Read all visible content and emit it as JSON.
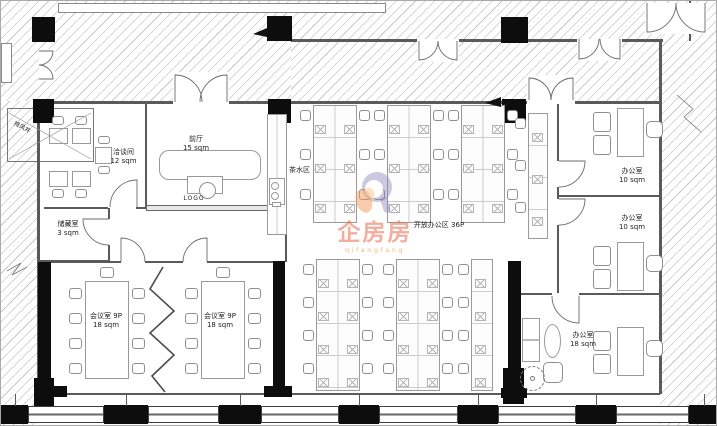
{
  "watermark": {
    "brand": "企房房",
    "pinyin": "qifangfang",
    "accent_orange": "#e96a4c",
    "accent_purple": "#9b96c4"
  },
  "rooms": {
    "exhaust_shaft": {
      "name": "排风井"
    },
    "lobby": {
      "name": "前厅",
      "area": "15 sqm"
    },
    "negotiation": {
      "name": "洽谈间",
      "area": "12 sqm"
    },
    "storage": {
      "name": "储藏室",
      "area": "3 sqm"
    },
    "tea": {
      "name": "茶水区"
    },
    "logo_wall": {
      "label": "LOGO"
    },
    "open_office": {
      "label": "开放办公区  36P"
    },
    "office_1": {
      "name": "办公室",
      "area": "10 sqm"
    },
    "office_2": {
      "name": "办公室",
      "area": "10 sqm"
    },
    "office_3": {
      "name": "办公室",
      "area": "18 sqm"
    },
    "meeting_left": {
      "name": "会议室  9P",
      "area": "18 sqm"
    },
    "meeting_right": {
      "name": "会议室  9P",
      "area": "18 sqm"
    }
  },
  "plan_colors": {
    "wall": "#5a5a5a",
    "column": "#0d0d0d",
    "hatch": "#c9c9c9"
  }
}
